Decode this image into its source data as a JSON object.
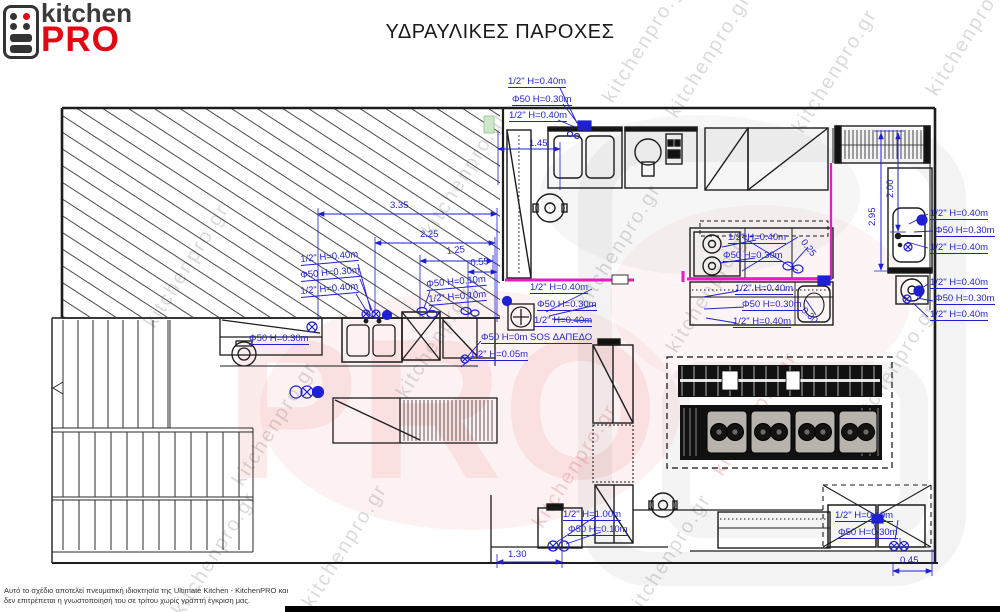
{
  "logo": {
    "kitchen": "kitchen",
    "pro": "PRO"
  },
  "title": "ΥΔΡΑΥΛΙΚΕΣ ΠΑΡΟΧΕΣ",
  "colors": {
    "annotation_blue": "#1f1fd4",
    "wall_black": "#1c1c1c",
    "wall_magenta": "#e71ac4",
    "logo_red": "#e30613"
  },
  "annotations": [
    {
      "text": "1/2\" H=0.40m",
      "x": 508,
      "y": 77,
      "u": 1
    },
    {
      "text": "Φ50 H=0.30m",
      "x": 512,
      "y": 95,
      "u": 1
    },
    {
      "text": "1/2\" H=0.40m",
      "x": 509,
      "y": 111,
      "u": 1
    },
    {
      "text": "1.45",
      "x": 529,
      "y": 139
    },
    {
      "text": "3.35",
      "x": 390,
      "y": 201
    },
    {
      "text": "2.25",
      "x": 420,
      "y": 230
    },
    {
      "text": "1.25",
      "x": 446,
      "y": 247,
      "rot": -6
    },
    {
      "text": "0.55",
      "x": 470,
      "y": 259,
      "rot": -6
    },
    {
      "text": "1/2\" H=0.40m",
      "x": 300,
      "y": 255,
      "u": 1,
      "rot": -5
    },
    {
      "text": "Φ50 H=0.30m",
      "x": 300,
      "y": 271,
      "u": 1,
      "rot": -5
    },
    {
      "text": "1/2\" H=0.40m",
      "x": 300,
      "y": 287,
      "u": 1,
      "rot": -5
    },
    {
      "text": "Φ50 H=0.10m",
      "x": 426,
      "y": 280,
      "u": 1,
      "rot": -5
    },
    {
      "text": "1/2\" H=0.10m",
      "x": 428,
      "y": 295,
      "u": 1,
      "rot": -5
    },
    {
      "text": "1/2\" H=0.40m",
      "x": 530,
      "y": 283,
      "u": 1
    },
    {
      "text": "Φ50 H=0.30m",
      "x": 537,
      "y": 300,
      "u": 1
    },
    {
      "text": "1/2\" H=0.40m",
      "x": 534,
      "y": 316,
      "u": 1
    },
    {
      "text": "Φ50 H=0m SOS ΔΑΠΕΔΟ",
      "x": 481,
      "y": 333,
      "u": 1
    },
    {
      "text": "1/2\" H=0.05m",
      "x": 470,
      "y": 350,
      "u": 1
    },
    {
      "text": "Φ50 H=0.30m",
      "x": 249,
      "y": 334,
      "u": 1
    },
    {
      "text": "1/2\" H=0.40m",
      "x": 728,
      "y": 233,
      "u": 1
    },
    {
      "text": "Φ50 H=0.30m",
      "x": 723,
      "y": 251,
      "u": 1
    },
    {
      "text": "0.25",
      "x": 806,
      "y": 238,
      "rot": 52
    },
    {
      "text": "1/2\" H=0.40m",
      "x": 735,
      "y": 284,
      "u": 1
    },
    {
      "text": "Φ50 H=0.30m",
      "x": 742,
      "y": 300,
      "u": 1
    },
    {
      "text": "1/2\" H=0.40m",
      "x": 733,
      "y": 317,
      "u": 1
    },
    {
      "text": "0.30",
      "x": 806,
      "y": 306,
      "rot": 45
    },
    {
      "text": "1/2\" H=0.40m",
      "x": 930,
      "y": 209,
      "u": 1
    },
    {
      "text": "Φ50 H=0.30m",
      "x": 935,
      "y": 226,
      "u": 1
    },
    {
      "text": "1/2\" H=0.40m",
      "x": 930,
      "y": 243,
      "u": 1
    },
    {
      "text": "1/2\" H=0.40m",
      "x": 930,
      "y": 278,
      "u": 1
    },
    {
      "text": "Φ50 H=0.30m",
      "x": 935,
      "y": 294,
      "u": 1
    },
    {
      "text": "1/2\" H=0.40m",
      "x": 930,
      "y": 310,
      "u": 1
    },
    {
      "text": "2.00",
      "x": 886,
      "y": 198,
      "rot": -90
    },
    {
      "text": "2.95",
      "x": 868,
      "y": 226,
      "rot": -90
    },
    {
      "text": "1/2\" H=1.00m",
      "x": 563,
      "y": 510,
      "u": 1
    },
    {
      "text": "Φ50 H=0.10m",
      "x": 568,
      "y": 525,
      "u": 1
    },
    {
      "text": "1.30",
      "x": 508,
      "y": 550
    },
    {
      "text": "1/2\" H=0.40m",
      "x": 835,
      "y": 511,
      "u": 1
    },
    {
      "text": "Φ50 H=0.30m",
      "x": 838,
      "y": 528,
      "u": 1
    },
    {
      "text": "0.45",
      "x": 900,
      "y": 556
    }
  ],
  "watermark": {
    "text": "kitchenpro.gr",
    "pro": "PRO",
    "items": [
      {
        "x": 140,
        "y": 320
      },
      {
        "x": 228,
        "y": 478
      },
      {
        "x": 298,
        "y": 600
      },
      {
        "x": 392,
        "y": 390
      },
      {
        "x": 418,
        "y": 228
      },
      {
        "x": 598,
        "y": 95
      },
      {
        "x": 572,
        "y": 300
      },
      {
        "x": 662,
        "y": 345
      },
      {
        "x": 708,
        "y": 468,
        "p": 1
      },
      {
        "x": 528,
        "y": 520,
        "p": 1
      },
      {
        "x": 622,
        "y": 610
      },
      {
        "x": 662,
        "y": 110
      },
      {
        "x": 788,
        "y": 125
      },
      {
        "x": 922,
        "y": 88
      },
      {
        "x": 848,
        "y": 420
      },
      {
        "x": 168,
        "y": 608
      }
    ]
  },
  "disclaimer": {
    "line1": "Αυτό το σχέδιο αποτελεί πνευματική ιδιοκτησία της Ultimate Kitchen - KitchenPRO και",
    "line2": "δεν επιτρέπεται η γνωστοποίησή του σε τρίτου χωρίς γραπτή έγκριση μας."
  }
}
